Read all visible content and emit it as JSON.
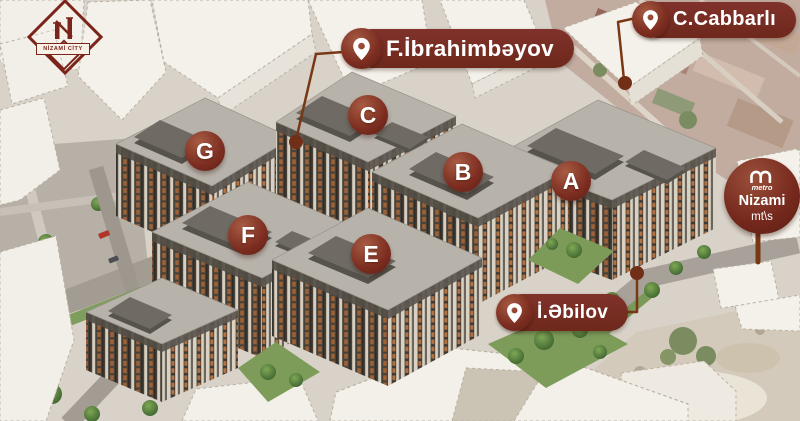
{
  "project": {
    "logo_title": "NİZAMİ CİTY"
  },
  "street_labels": [
    {
      "name": "F.İbrahimbəyov"
    },
    {
      "name": "C.Cabbarlı"
    },
    {
      "name": "İ.Əbilov"
    }
  ],
  "building_markers": [
    {
      "label": "A"
    },
    {
      "label": "B"
    },
    {
      "label": "C"
    },
    {
      "label": "E"
    },
    {
      "label": "F"
    },
    {
      "label": "G"
    }
  ],
  "metro": {
    "logo_text": "metro",
    "station_name": "Nizami",
    "station_type": "mt\\s"
  },
  "colors": {
    "accent_maroon": "#76291d",
    "leader_line": "#7a3714",
    "facade_orange": "#b5713f"
  }
}
